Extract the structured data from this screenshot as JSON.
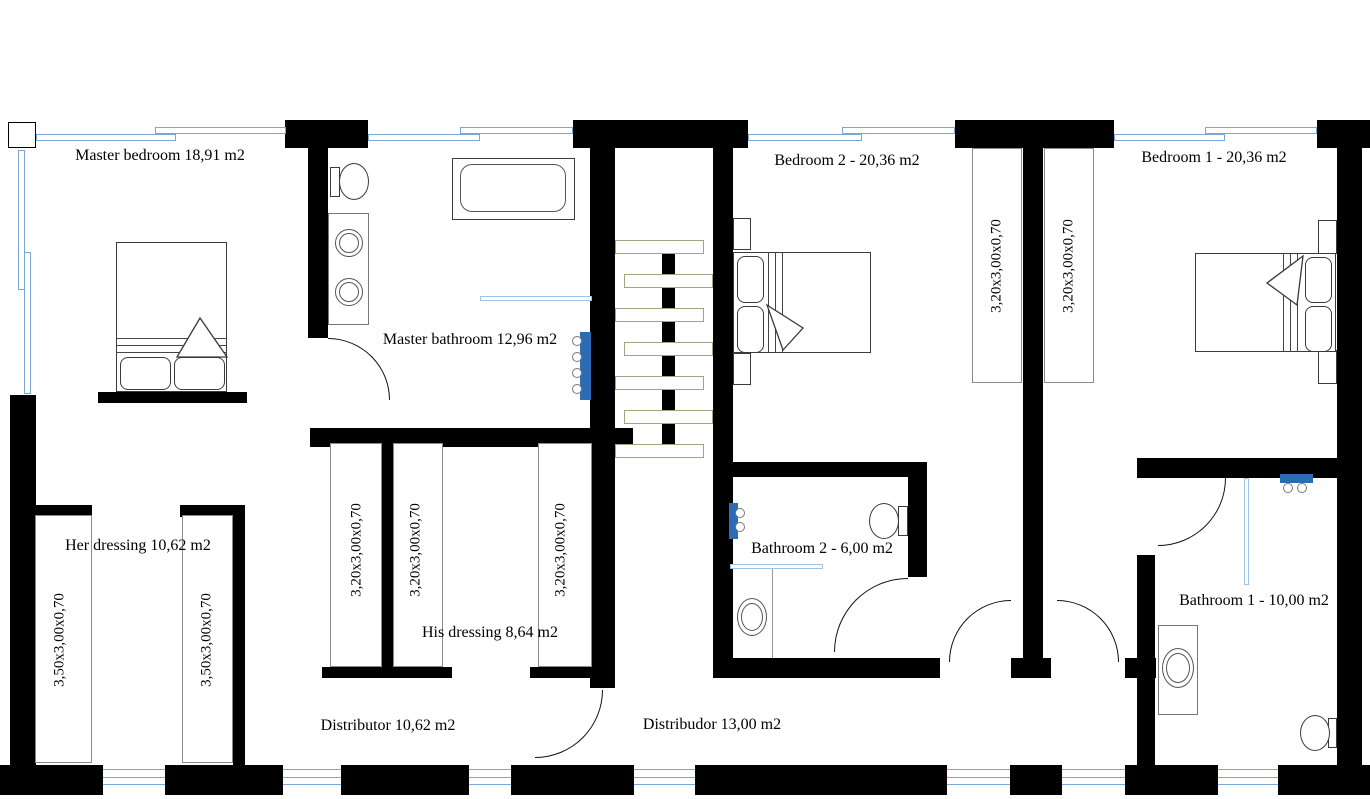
{
  "title": "Upper floor plan",
  "rooms": {
    "master_bedroom": {
      "label": "Master bedroom 18,91 m2"
    },
    "master_bathroom": {
      "label": "Master bathroom 12,96 m2"
    },
    "bedroom2": {
      "label": "Bedroom 2 - 20,36 m2"
    },
    "bedroom1": {
      "label": "Bedroom 1 - 20,36 m2"
    },
    "her_dressing": {
      "label": "Her dressing 10,62 m2"
    },
    "his_dressing": {
      "label": "His dressing 8,64 m2"
    },
    "bathroom2": {
      "label": "Bathroom 2 - 6,00 m2"
    },
    "bathroom1": {
      "label": "Bathroom 1 - 10,00 m2"
    },
    "distributor": {
      "label": "Distributor 10,62 m2"
    },
    "distribudor": {
      "label": "Distribudor 13,00 m2"
    }
  },
  "closets": {
    "her_left": "3,50x3,00x0,70",
    "her_right": "3,50x3,00x0,70",
    "hall": "3,20x3,00x0,70",
    "his_left": "3,20x3,00x0,70",
    "his_right": "3,20x3,00x0,70",
    "bedroom2": "3,20x3,00x0,70",
    "bedroom1": "3,20x3,00x0,70"
  },
  "colors": {
    "wall": "#000000",
    "window": "#7ba7d7",
    "radiator": "#2d6cb5",
    "stair_tread_outline": "#a3a382",
    "furniture_outline": "#3a3a3a"
  }
}
